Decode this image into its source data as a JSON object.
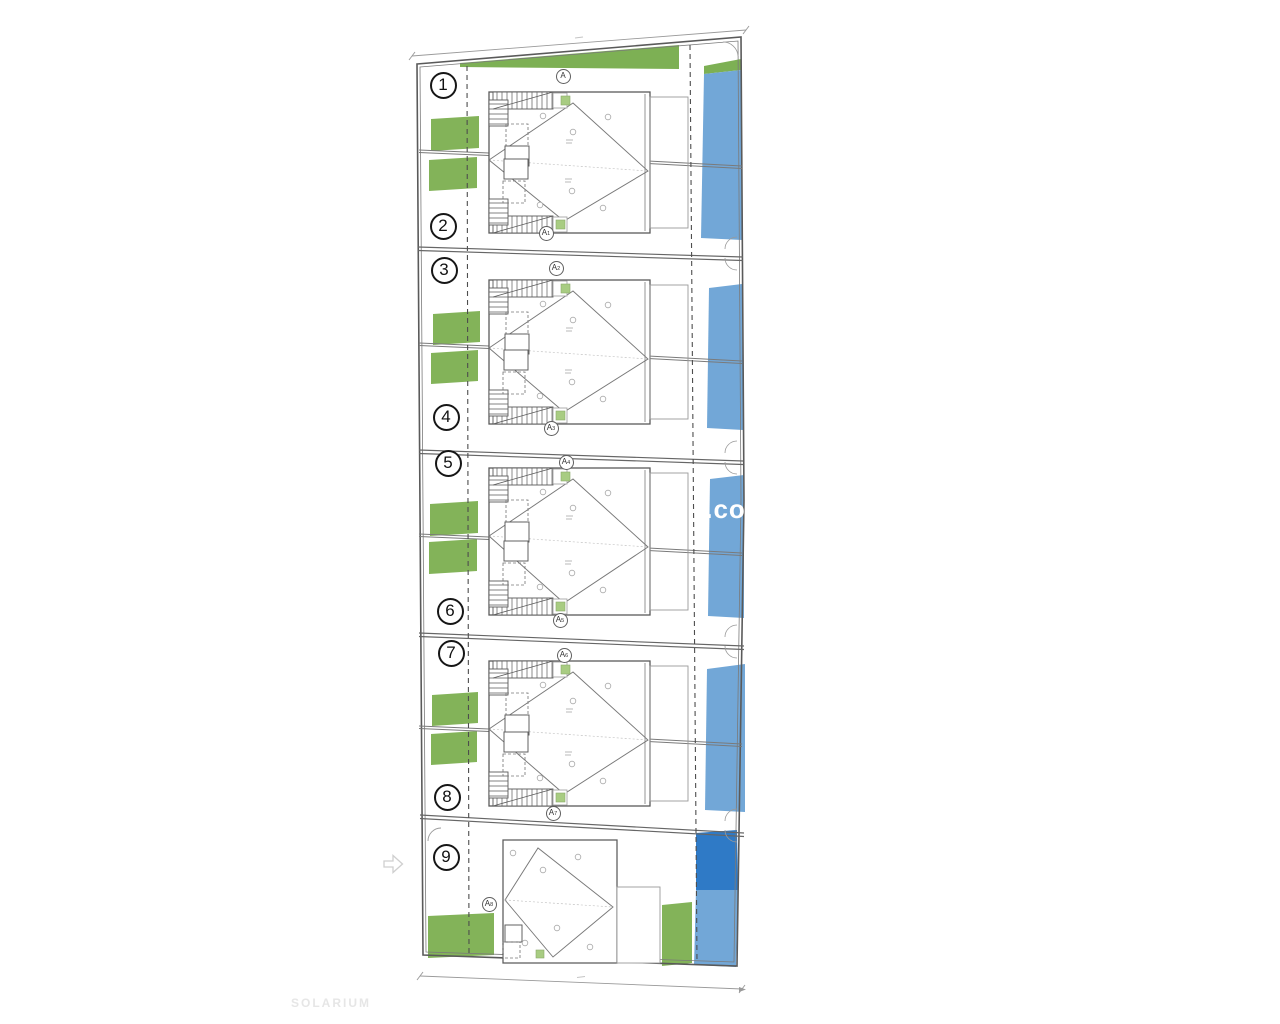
{
  "page": {
    "background": "#ffffff"
  },
  "watermark": {
    "text": "l.com",
    "color": "#ffffff"
  },
  "footer": {
    "solarium_label": "SOLARIUM"
  },
  "palette": {
    "garden_green": "#83b359",
    "top_strip_green": "#7db054",
    "entry_green": "#a8cc82",
    "pool_blue": "#72a7d7",
    "pool_blue_dark": "#2f7ac6",
    "line_dark": "#5a5a5a",
    "line_mid": "#7a7a7a",
    "line_light": "#9a9a9a",
    "badge_border": "#161616"
  },
  "units": [
    {
      "number": "1",
      "cx": 443,
      "cy": 85
    },
    {
      "number": "2",
      "cx": 443,
      "cy": 226
    },
    {
      "number": "3",
      "cx": 444,
      "cy": 270
    },
    {
      "number": "4",
      "cx": 446,
      "cy": 417
    },
    {
      "number": "5",
      "cx": 448,
      "cy": 463
    },
    {
      "number": "6",
      "cx": 450,
      "cy": 611
    },
    {
      "number": "7",
      "cx": 451,
      "cy": 653
    },
    {
      "number": "8",
      "cx": 447,
      "cy": 797
    },
    {
      "number": "9",
      "cx": 446,
      "cy": 857
    }
  ],
  "section_markers": [
    {
      "label": "A",
      "sub": "",
      "cx": 563,
      "cy": 76
    },
    {
      "label": "A",
      "sub": "1",
      "cx": 546,
      "cy": 233
    },
    {
      "label": "A",
      "sub": "2",
      "cx": 556,
      "cy": 268
    },
    {
      "label": "A",
      "sub": "3",
      "cx": 551,
      "cy": 428
    },
    {
      "label": "A",
      "sub": "4",
      "cx": 566,
      "cy": 462
    },
    {
      "label": "A",
      "sub": "5",
      "cx": 560,
      "cy": 620
    },
    {
      "label": "A",
      "sub": "6",
      "cx": 564,
      "cy": 655
    },
    {
      "label": "A",
      "sub": "7",
      "cx": 553,
      "cy": 813
    },
    {
      "label": "A",
      "sub": "8",
      "cx": 489,
      "cy": 904
    }
  ],
  "plan": {
    "site_boundary": [
      [
        417,
        64
      ],
      [
        741,
        37
      ],
      [
        744,
        500
      ],
      [
        737,
        966
      ],
      [
        423,
        955
      ]
    ],
    "site_boundary_inner": [
      [
        420,
        67
      ],
      [
        738,
        41
      ],
      [
        741,
        500
      ],
      [
        734,
        962
      ],
      [
        426,
        952
      ]
    ],
    "top_dim": [
      412,
      56,
      746,
      30
    ],
    "bottom_dim": [
      420,
      976,
      742,
      989
    ],
    "separations": [
      [
        418,
        247,
        743,
        257
      ],
      [
        419,
        450,
        743,
        461
      ],
      [
        419,
        633,
        744,
        646
      ],
      [
        420,
        815,
        744,
        833
      ]
    ],
    "mid_fences": [
      {
        "left": [
          419,
          150,
          489,
          153
        ],
        "right": [
          648,
          161,
          742,
          166
        ]
      },
      {
        "left": [
          419,
          343,
          489,
          346
        ],
        "right": [
          648,
          356,
          742,
          361
        ]
      },
      {
        "left": [
          419,
          534,
          489,
          537
        ],
        "right": [
          648,
          548,
          742,
          553
        ]
      },
      {
        "left": [
          419,
          726,
          489,
          729
        ],
        "right": [
          648,
          739,
          742,
          744
        ]
      }
    ],
    "dashed_lines": [
      [
        467,
        66,
        469,
        954
      ],
      [
        690,
        45,
        697,
        963
      ]
    ],
    "top_green_wedge": [
      [
        460,
        63
      ],
      [
        679,
        45
      ],
      [
        679,
        69
      ],
      [
        460,
        67
      ]
    ],
    "pool_top_green": [
      [
        704,
        66
      ],
      [
        741,
        59
      ],
      [
        741,
        70
      ],
      [
        704,
        74
      ]
    ],
    "gardens": [
      [
        431,
        116,
        48,
        32
      ],
      [
        429,
        157,
        48,
        31
      ],
      [
        433,
        311,
        47,
        31
      ],
      [
        431,
        350,
        47,
        31
      ],
      [
        430,
        501,
        48,
        32
      ],
      [
        429,
        539,
        48,
        32
      ],
      [
        432,
        692,
        46,
        31
      ],
      [
        431,
        731,
        46,
        31
      ],
      [
        428,
        913,
        66,
        42
      ],
      [
        662,
        902,
        30,
        61
      ]
    ],
    "pools": [
      [
        [
          704,
          74
        ],
        [
          741,
          70
        ],
        [
          742,
          240
        ],
        [
          701,
          238
        ]
      ],
      [
        [
          709,
          288
        ],
        [
          742,
          284
        ],
        [
          743,
          430
        ],
        [
          707,
          428
        ]
      ],
      [
        [
          710,
          479
        ],
        [
          744,
          475
        ],
        [
          744,
          618
        ],
        [
          708,
          616
        ]
      ],
      [
        [
          707,
          669
        ],
        [
          745,
          664
        ],
        [
          745,
          812
        ],
        [
          705,
          810
        ]
      ],
      [
        [
          696,
          890
        ],
        [
          738,
          890
        ],
        [
          736,
          967
        ],
        [
          694,
          965
        ]
      ]
    ],
    "pool_dark": [
      [
        696,
        833
      ],
      [
        737,
        830
      ],
      [
        738,
        890
      ],
      [
        696,
        890
      ]
    ],
    "blocks": [
      {
        "bt": 92,
        "bb": 233
      },
      {
        "bt": 280,
        "bb": 424
      },
      {
        "bt": 468,
        "bb": 615
      },
      {
        "bt": 661,
        "bb": 806
      }
    ],
    "unit9": {
      "building": [
        503,
        840,
        114,
        123
      ],
      "extension": [
        617,
        887,
        43,
        76
      ],
      "diamond": [
        [
          505,
          900
        ],
        [
          538,
          848
        ],
        [
          613,
          907
        ],
        [
          553,
          957
        ]
      ],
      "room_solid": [
        505,
        925,
        17,
        17
      ],
      "room_dashed": [
        503,
        942,
        17,
        16
      ],
      "entry_green": [
        536,
        950,
        8,
        8
      ],
      "drains": [
        [
          513,
          853
        ],
        [
          578,
          857
        ],
        [
          543,
          870
        ],
        [
          557,
          928
        ],
        [
          525,
          943
        ],
        [
          590,
          947
        ]
      ],
      "door_arc": "M428,841 A13,13 0 0 1 441,828"
    },
    "corner_arcs_right_y": [
      252,
      456,
      640,
      824
    ],
    "top_corner_arc": "M723,42 A15,15 0 0 1 738,56",
    "arrow": "M384,861 h9 v-5.5 l9.5,8.5 l-9.5,8.5 v-5.5 h-9 z"
  }
}
